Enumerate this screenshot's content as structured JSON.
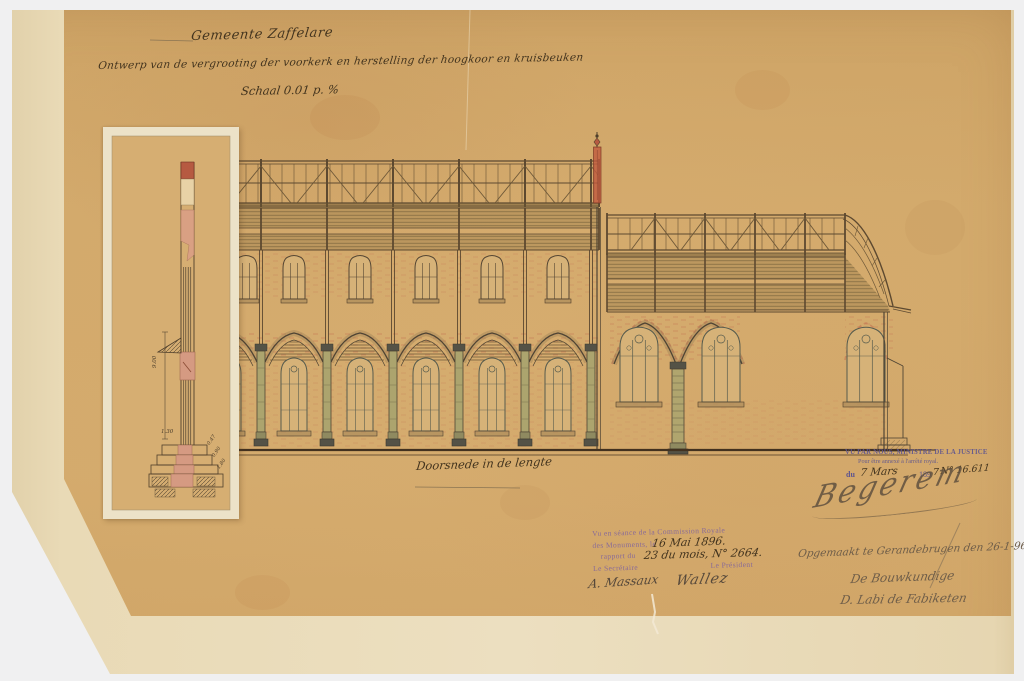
{
  "title_block": {
    "municipality": "Gemeente Zaffelare",
    "subtitle": "Ontwerp van de vergrooting der voorkerk en herstelling der hoogkoor en kruisbeuken",
    "scale": "Schaal 0.01 p. %"
  },
  "caption": {
    "label": "Doorsnede in de lengte"
  },
  "inset": {
    "dims": [
      "9.00",
      "1.30",
      "0.47",
      "0.90",
      "1.80"
    ]
  },
  "commission_stamp": {
    "line1": "Vu en séance de la Commission Royale",
    "line2": "des Monuments, le",
    "line3": "rapport du",
    "date": "16 Mai 1896.",
    "ref": "23 du mois, N° 2664.",
    "secretary_label": "Le Secrétaire",
    "president_label": "Le Président",
    "secretary_signature": "A. Massaux",
    "president_signature": "Wallez"
  },
  "justice_stamp": {
    "line1": "VU PAR NOUS, MINISTRE DE LA JUSTICE",
    "line2": "Pour être annexé à l'arrêté royal.",
    "du": "du",
    "date": "7 Mars",
    "year_prefix": "189",
    "year_digit": "7",
    "number": "N° 16.611",
    "signature": "Begerem"
  },
  "colophon": {
    "line1": "Opgemaakt te Gerandebrugen den 26-1-96",
    "line2": "De Bouwkundige",
    "line3": "D. Labi de Fabiketen"
  },
  "palette": {
    "paper": "#d2a96b",
    "backing": "#ecdfc0",
    "ink": "#4f3f2b",
    "timber_wash": "#8a6f42",
    "column_olive": "#aca46e",
    "brick_red": "#c06a4e",
    "fleche_red": "#c15a3e",
    "stamp_purple": "#7b5fa0",
    "justice_purple": "#5d5490",
    "pencil": "#6e5d49"
  }
}
